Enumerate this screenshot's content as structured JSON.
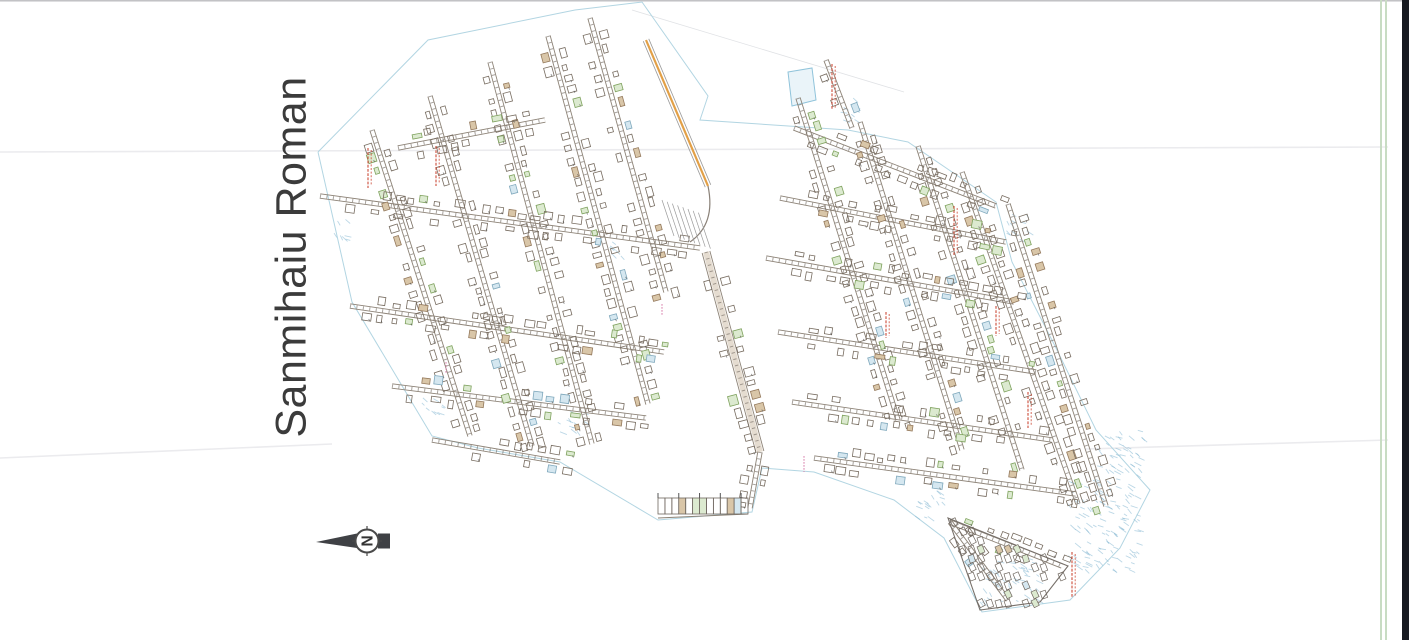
{
  "title": "Sanmihaiu Roman",
  "compass": {
    "letter": "N",
    "cx": 367,
    "cy": 541,
    "r": 11.5,
    "tip_x": 316,
    "bar_x2": 390
  },
  "colors": {
    "title_text": "#3b3b3b",
    "street_line": "#8d8377",
    "street_tick": "#6f675f",
    "building_stroke": "#776c60",
    "building_green_fill": "#dcead0",
    "building_green_stroke": "#7fa25e",
    "building_tan_fill": "#d9c6a8",
    "building_tan_stroke": "#94795c",
    "building_blue_fill": "#d5e7f0",
    "building_blue_stroke": "#7fa8bc",
    "boundary_blue": "#aed3e0",
    "red_label": "#cc4a36",
    "pink_label": "#d87aa8",
    "orange_road": "#e2a047",
    "faint_line": "#ebebee",
    "compass_dark": "#3f4145"
  },
  "map_geometry": {
    "boundary": [
      [
        318,
        152
      ],
      [
        428,
        40
      ],
      [
        575,
        10
      ],
      [
        642,
        2
      ],
      [
        708,
        96
      ],
      [
        700,
        120
      ],
      [
        848,
        130
      ],
      [
        908,
        142
      ],
      [
        996,
        202
      ],
      [
        1012,
        262
      ],
      [
        1056,
        348
      ],
      [
        1096,
        430
      ],
      [
        1150,
        490
      ],
      [
        1120,
        548
      ],
      [
        1070,
        600
      ],
      [
        982,
        612
      ],
      [
        944,
        538
      ],
      [
        894,
        500
      ],
      [
        814,
        472
      ],
      [
        762,
        468
      ],
      [
        752,
        512
      ],
      [
        658,
        520
      ],
      [
        560,
        462
      ],
      [
        478,
        448
      ],
      [
        432,
        436
      ],
      [
        352,
        302
      ],
      [
        318,
        152
      ]
    ],
    "streets_steep": [
      [
        372,
        130,
        470,
        436
      ],
      [
        430,
        96,
        532,
        446
      ],
      [
        490,
        62,
        592,
        444
      ],
      [
        548,
        36,
        648,
        404
      ],
      [
        590,
        18,
        666,
        292
      ],
      [
        798,
        98,
        898,
        420
      ],
      [
        860,
        122,
        962,
        450
      ],
      [
        918,
        146,
        1022,
        470
      ],
      [
        962,
        172,
        1078,
        504
      ],
      [
        1008,
        204,
        1106,
        506
      ],
      [
        826,
        60,
        852,
        128
      ]
    ],
    "streets_cross": [
      [
        320,
        196,
        700,
        248
      ],
      [
        350,
        306,
        664,
        352
      ],
      [
        392,
        386,
        646,
        418
      ],
      [
        432,
        440,
        560,
        462
      ],
      [
        398,
        148,
        545,
        120
      ],
      [
        794,
        128,
        996,
        206
      ],
      [
        780,
        198,
        1006,
        242
      ],
      [
        766,
        258,
        1014,
        302
      ],
      [
        778,
        332,
        1036,
        372
      ],
      [
        792,
        402,
        1052,
        440
      ],
      [
        814,
        458,
        1076,
        494
      ]
    ],
    "streets_central": [
      [
        706,
        252,
        760,
        452
      ],
      [
        760,
        452,
        750,
        508
      ]
    ],
    "orange_road": [
      646,
      40,
      708,
      186
    ],
    "junction_curve": "M 708,186 Q 716,224 690,242",
    "hatch_zone": {
      "x": 662,
      "y": 200,
      "n": 8
    },
    "parcel_row": {
      "x1": 658,
      "y1": 514,
      "x2": 748,
      "y2": 510,
      "h": 16,
      "cols": 13
    },
    "triangle": {
      "outline": [
        [
          948,
          518
        ],
        [
          1068,
          566
        ],
        [
          1040,
          602
        ],
        [
          980,
          610
        ]
      ],
      "inner_streets": [
        [
          950,
          522,
          1062,
          566
        ],
        [
          950,
          522,
          1008,
          600
        ]
      ]
    },
    "blue_parallelogram": [
      [
        788,
        72
      ],
      [
        812,
        68
      ],
      [
        816,
        100
      ],
      [
        792,
        106
      ]
    ],
    "red_labels": [
      [
        368,
        148,
        40
      ],
      [
        436,
        146,
        40
      ],
      [
        832,
        64,
        46
      ],
      [
        954,
        206,
        50
      ],
      [
        886,
        312,
        26
      ],
      [
        996,
        306,
        30
      ],
      [
        1028,
        392,
        36
      ],
      [
        1072,
        552,
        46
      ]
    ],
    "pink_labels": [
      [
        804,
        456,
        16
      ],
      [
        446,
        362,
        12
      ],
      [
        662,
        304,
        12
      ]
    ],
    "blue_patches": [
      [
        1066,
        478,
        72,
        92
      ],
      [
        1094,
        430,
        48,
        46
      ],
      [
        980,
        556,
        58,
        46
      ],
      [
        914,
        490,
        32,
        28
      ],
      [
        1006,
        214,
        24,
        28
      ],
      [
        556,
        406,
        28,
        26
      ],
      [
        418,
        396,
        24,
        24
      ],
      [
        334,
        218,
        18,
        22
      ],
      [
        606,
        240,
        20,
        16
      ],
      [
        836,
        96,
        20,
        26
      ]
    ],
    "faint_lines": [
      [
        0,
        152,
        1388,
        147
      ],
      [
        0,
        458,
        332,
        444
      ],
      [
        1086,
        449,
        1388,
        440
      ]
    ],
    "diag_faint": [
      632,
      10,
      904,
      92
    ]
  }
}
